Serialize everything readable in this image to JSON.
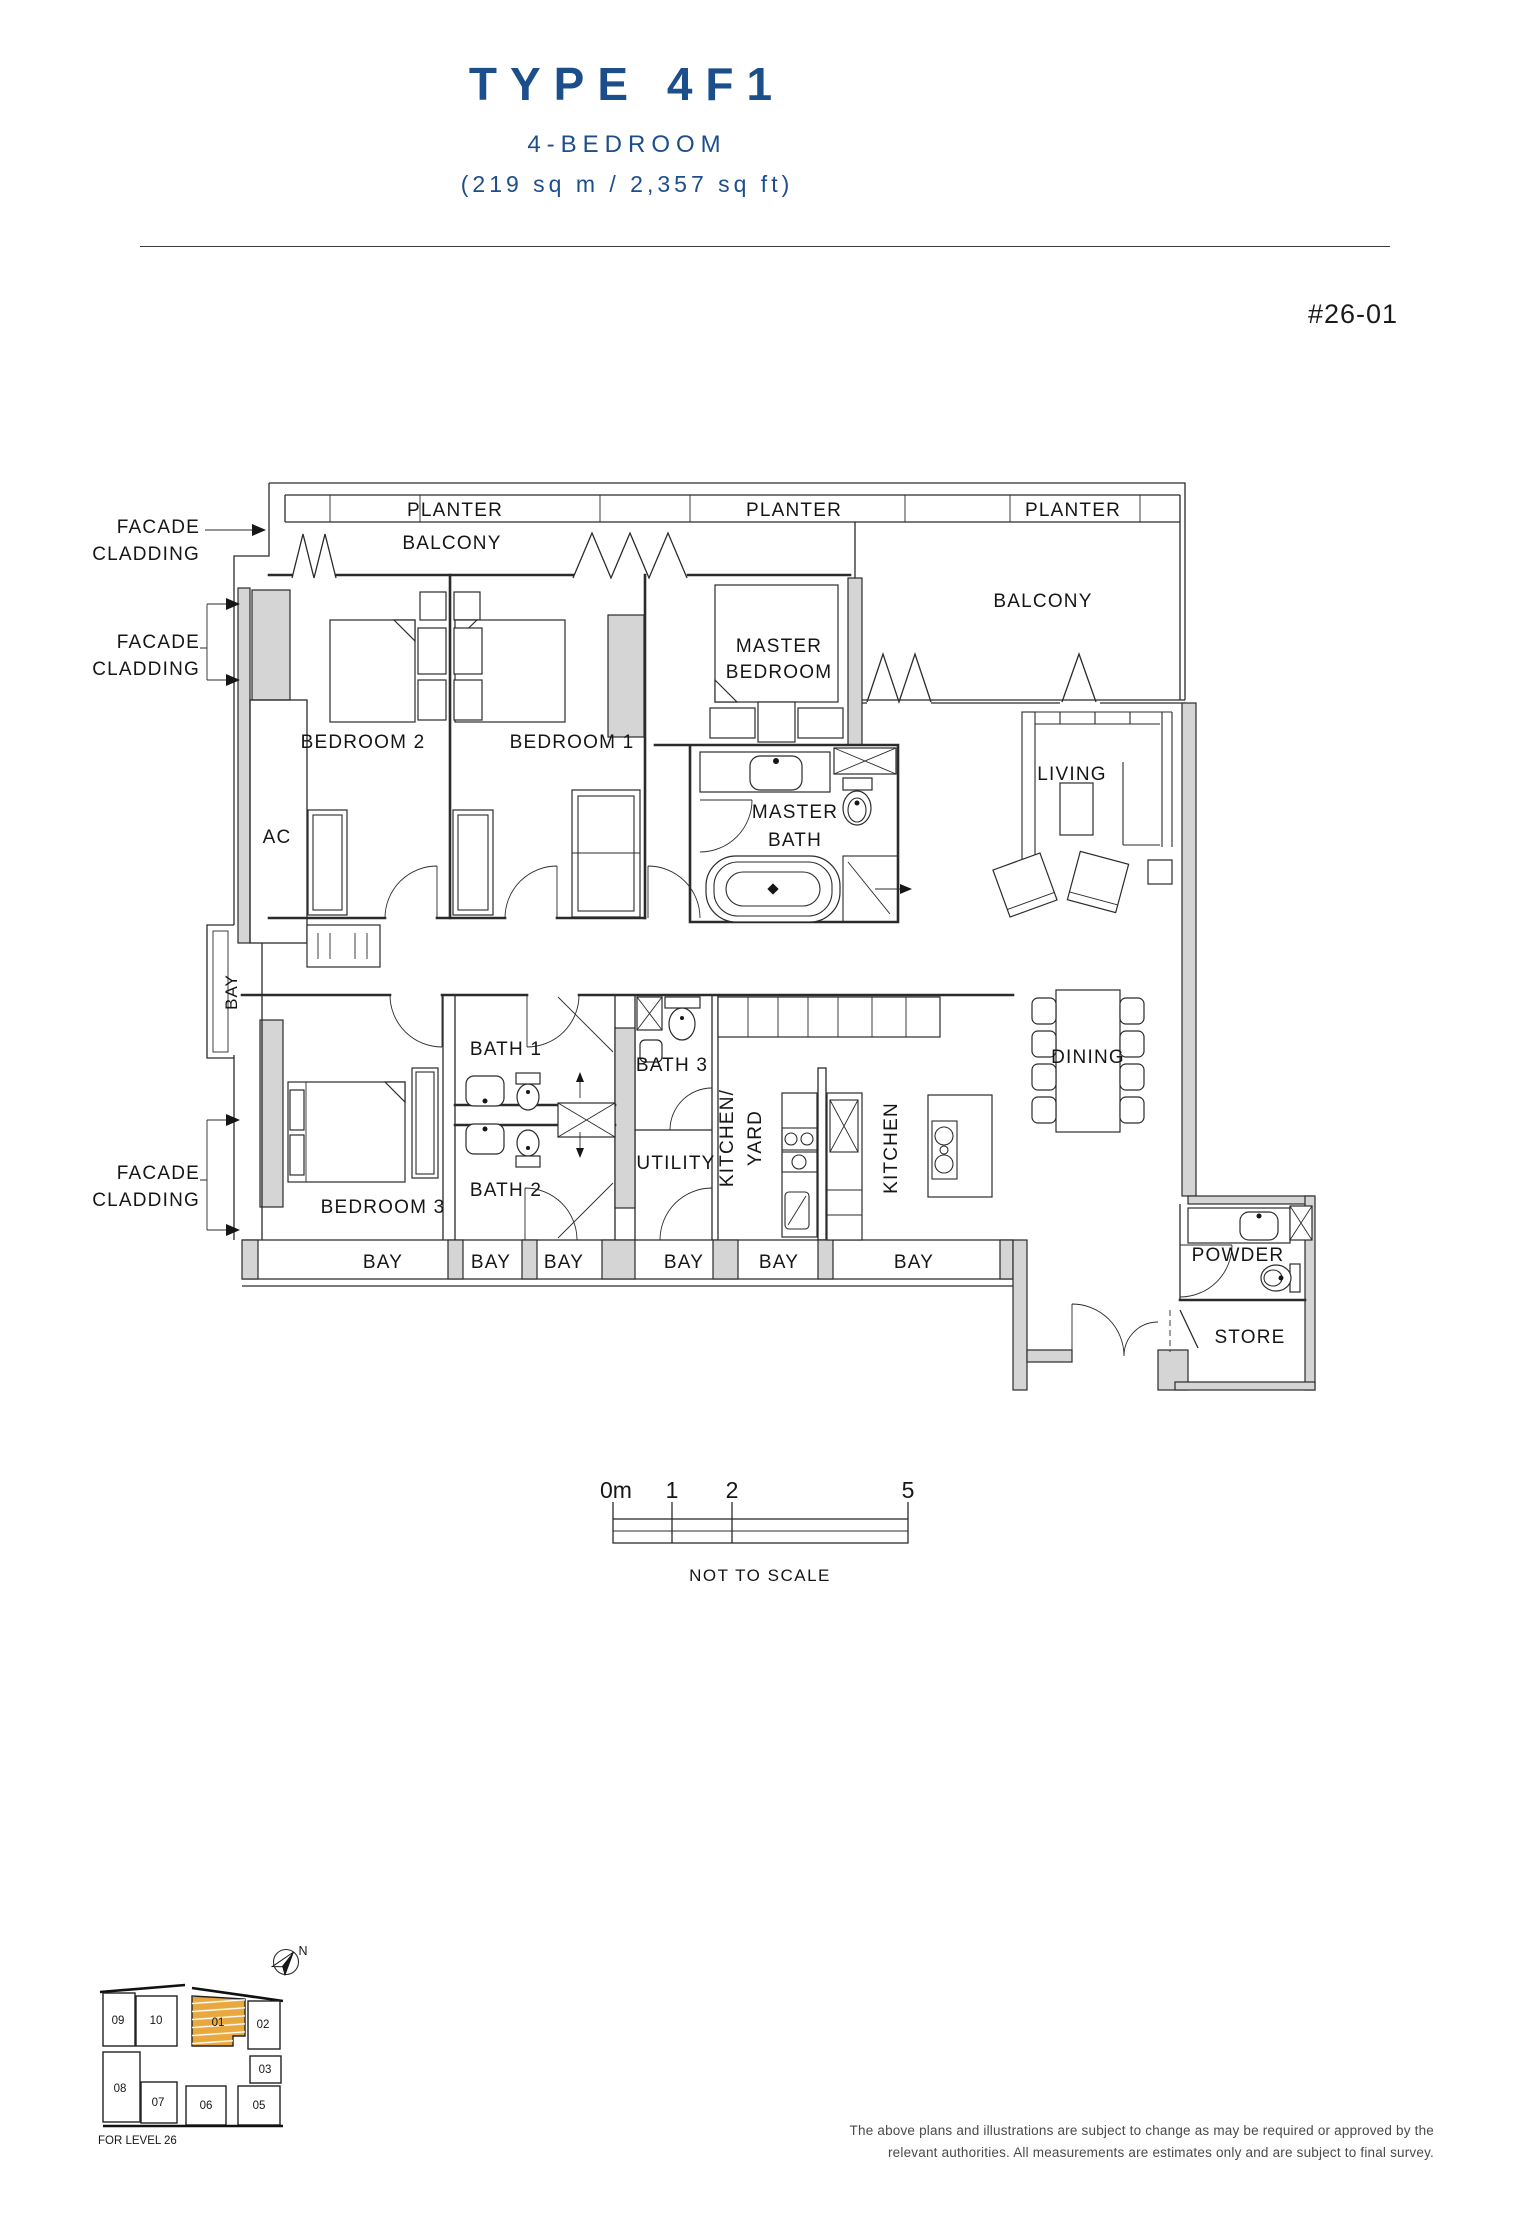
{
  "header": {
    "title": "TYPE 4F1",
    "subtitle": "4-BEDROOM",
    "area": "(219 sq m / 2,357 sq ft)",
    "unit_number": "#26-01"
  },
  "plan": {
    "planters": [
      "PLANTER",
      "PLANTER",
      "PLANTER"
    ],
    "balcony_left": "BALCONY",
    "balcony_right": "BALCONY",
    "facade_cladding": {
      "line1": "FACADE",
      "line2": "CLADDING"
    },
    "master_bedroom": {
      "line1": "MASTER",
      "line2": "BEDROOM"
    },
    "bedroom1": "BEDROOM 1",
    "bedroom2": "BEDROOM 2",
    "bedroom3": "BEDROOM 3",
    "master_bath": {
      "line1": "MASTER",
      "line2": "BATH"
    },
    "living": "LIVING",
    "dining": "DINING",
    "ac": "AC",
    "bay_side": "BAY",
    "bath1": "BATH 1",
    "bath2": "BATH 2",
    "bath3": "BATH 3",
    "utility": "UTILITY",
    "kitchen_yard": {
      "line1": "KITCHEN/",
      "line2": "YARD"
    },
    "kitchen": "KITCHEN",
    "powder": "POWDER",
    "store": "STORE",
    "bays_bottom": [
      "BAY",
      "BAY",
      "BAY",
      "BAY",
      "BAY",
      "BAY"
    ]
  },
  "scale_bar": {
    "ticks": [
      "0m",
      "1",
      "2",
      "5"
    ],
    "note": "NOT TO SCALE"
  },
  "key_plan": {
    "units": [
      "09",
      "10",
      "01",
      "02",
      "03",
      "08",
      "07",
      "06",
      "05"
    ],
    "highlighted_unit": "01",
    "compass": "N",
    "level_note": "FOR LEVEL 26"
  },
  "footer": {
    "disclaimer_line1": "The above plans and illustrations are subject to change as may be required or approved by the",
    "disclaimer_line2": "relevant authorities. All measurements are estimates only and are subject to final survey."
  },
  "colors": {
    "accent_blue": "#1d4e8c",
    "wall_fill": "#d5d5d5",
    "unit_highlight": "#e8a83e",
    "line": "#2b2b2b"
  }
}
